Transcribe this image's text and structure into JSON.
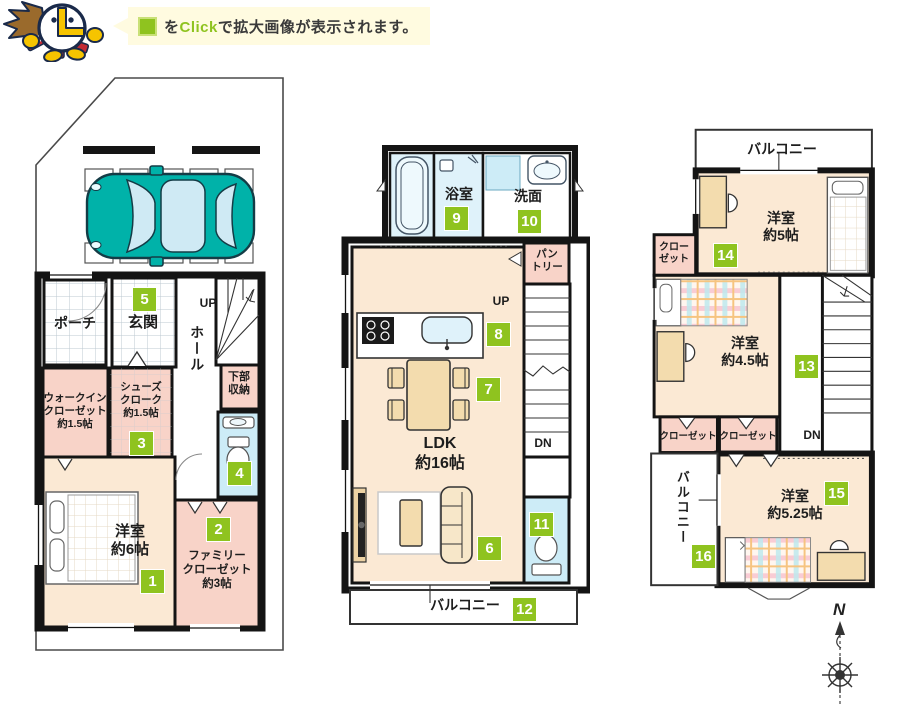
{
  "header": {
    "bubble_pre": "を",
    "bubble_highlight": "Click",
    "bubble_post": "で拡大画像が表示されます。"
  },
  "colors": {
    "accent_green": "#8fc31f",
    "room_cream": "#fbe9d4",
    "closet_pink": "#f8d3c8",
    "wet_area_blue": "#cdecf7",
    "car_teal": "#00b2a9",
    "wall_black": "#141414"
  },
  "floor1": {
    "porch": "ポーチ",
    "entrance": "玄関",
    "hall": "ホール",
    "up_label": "UP",
    "under_stair_storage": "下部\n収納",
    "walk_in_closet": "ウォークイン\nクローゼット\n約1.5帖",
    "shoes_cloak": "シューズ\nクローク\n約1.5帖",
    "bedroom_6": "洋室\n約6帖",
    "family_closet": "ファミリー\nクローゼット\n約3帖"
  },
  "floor2": {
    "bath": "浴室",
    "washroom": "洗面",
    "pantry": "パン\nトリー",
    "up_label": "UP",
    "ldk": "LDK\n約16帖",
    "down_label": "DN",
    "balcony": "バルコニー"
  },
  "floor3": {
    "balcony_top": "バルコニー",
    "bedroom_5": "洋室\n約5帖",
    "closet_upper": "クロー\nゼット",
    "bedroom_45": "洋室\n約4.5帖",
    "closet_left": "クローゼット",
    "closet_right": "クローゼット",
    "down_label": "DN",
    "balcony_left": "バルコニー",
    "bedroom_525": "洋室\n約5.25帖"
  },
  "badges": {
    "n1": "1",
    "n2": "2",
    "n3": "3",
    "n4": "4",
    "n5": "5",
    "n6": "6",
    "n7": "7",
    "n8": "8",
    "n9": "9",
    "n10": "10",
    "n11": "11",
    "n12": "12",
    "n13": "13",
    "n14": "14",
    "n15": "15",
    "n16": "16"
  },
  "compass": {
    "north": "N"
  }
}
